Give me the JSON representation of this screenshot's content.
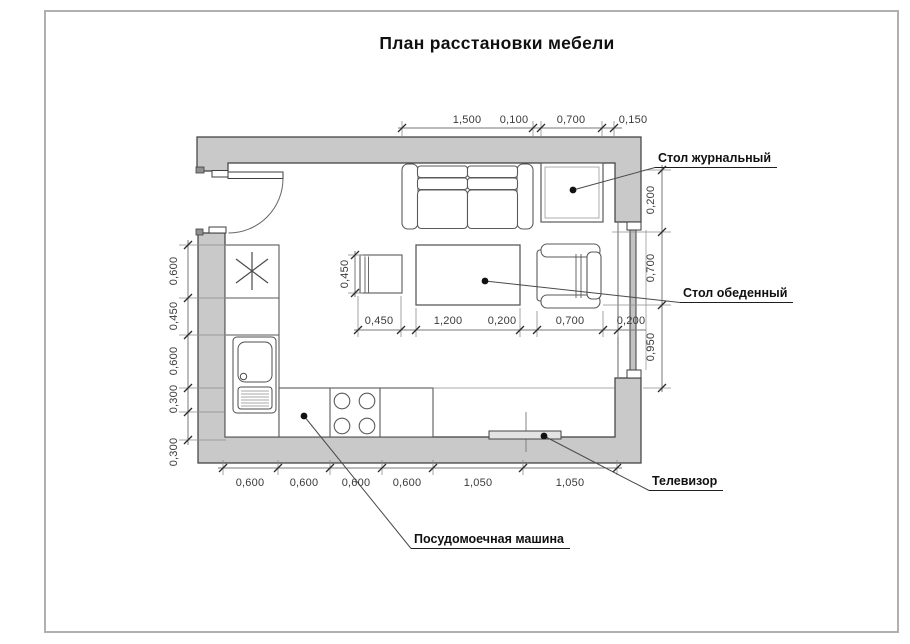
{
  "title": "План расстановки мебели",
  "labels": {
    "coffee_table": "Стол журнальный",
    "dining_table": "Стол обеденный",
    "tv": "Телевизор",
    "dishwasher": "Посудомоечная машина"
  },
  "dims": {
    "top": [
      "1,500",
      "0,100",
      "0,700",
      "0,150"
    ],
    "middle": [
      "0,450",
      "1,200",
      "0,200",
      "0,700",
      "0,200"
    ],
    "bottom": [
      "0,600",
      "0,600",
      "0,600",
      "0,600",
      "1,050",
      "1,050"
    ],
    "left": [
      "0,600",
      "0,450",
      "0,600",
      "0,300",
      "0,300"
    ],
    "right": [
      "0,200",
      "0,700",
      "0,950"
    ],
    "stool": "0,450"
  },
  "colors": {
    "wall_fill": "#c9c9c9",
    "outline": "#3e3e3e",
    "furniture_line": "#5a5a5a",
    "dim_line": "#787878",
    "dim_text": "#3a3a3a",
    "page_frame": "#b0b0b0",
    "tv_fill": "#e3e3e3"
  }
}
